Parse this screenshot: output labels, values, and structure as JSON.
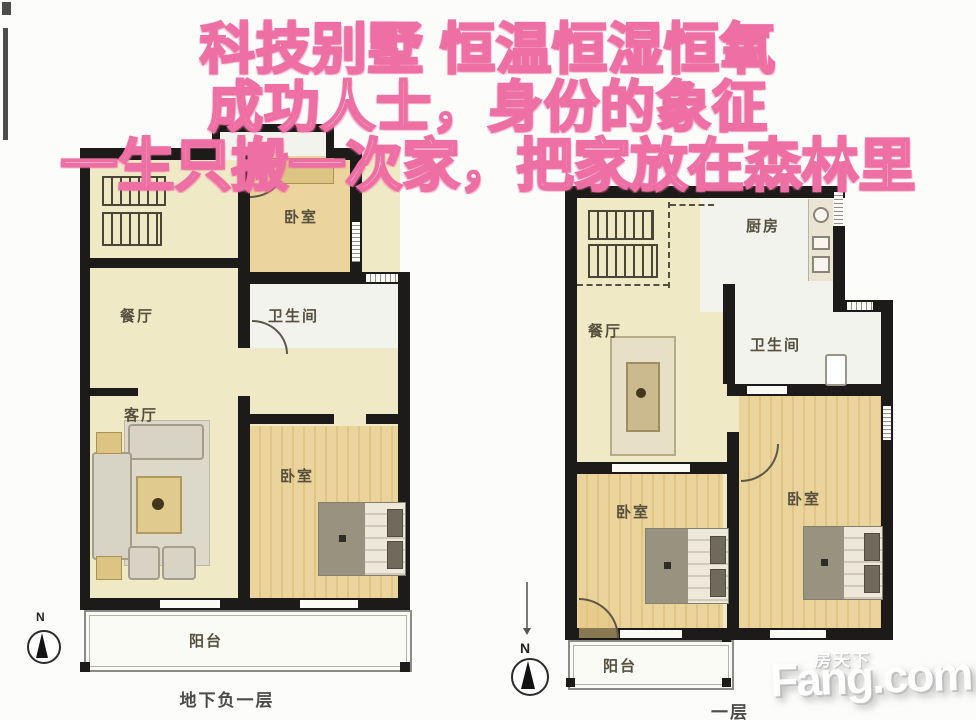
{
  "headline": {
    "line1": "科技别墅 恒温恒湿恒氧",
    "line2": "成功人士，身份的象征",
    "line3": "一生只搬一次家，把家放在森林里"
  },
  "plan_left": {
    "caption": "地下负一层",
    "compass": "N",
    "rooms": {
      "bedroom_top": "卧室",
      "dining": "餐厅",
      "bathroom": "卫生间",
      "living": "客厅",
      "bedroom_bottom": "卧室",
      "balcony": "阳台"
    }
  },
  "plan_right": {
    "caption": "一层",
    "compass": "N",
    "rooms": {
      "kitchen": "厨房",
      "dining": "餐厅",
      "bathroom": "卫生间",
      "bedroom_left": "卧室",
      "bedroom_right": "卧室",
      "balcony": "阳台"
    }
  },
  "watermark": {
    "site_cn": "房天下",
    "site_en": "Fang.com"
  },
  "colors": {
    "headline_pink": "#ee6fa3",
    "wall": "#1c1b19",
    "floor_cream": "#f0e9c6",
    "floor_wood": "#e8cd8e",
    "floor_white": "#f3f3ee"
  }
}
